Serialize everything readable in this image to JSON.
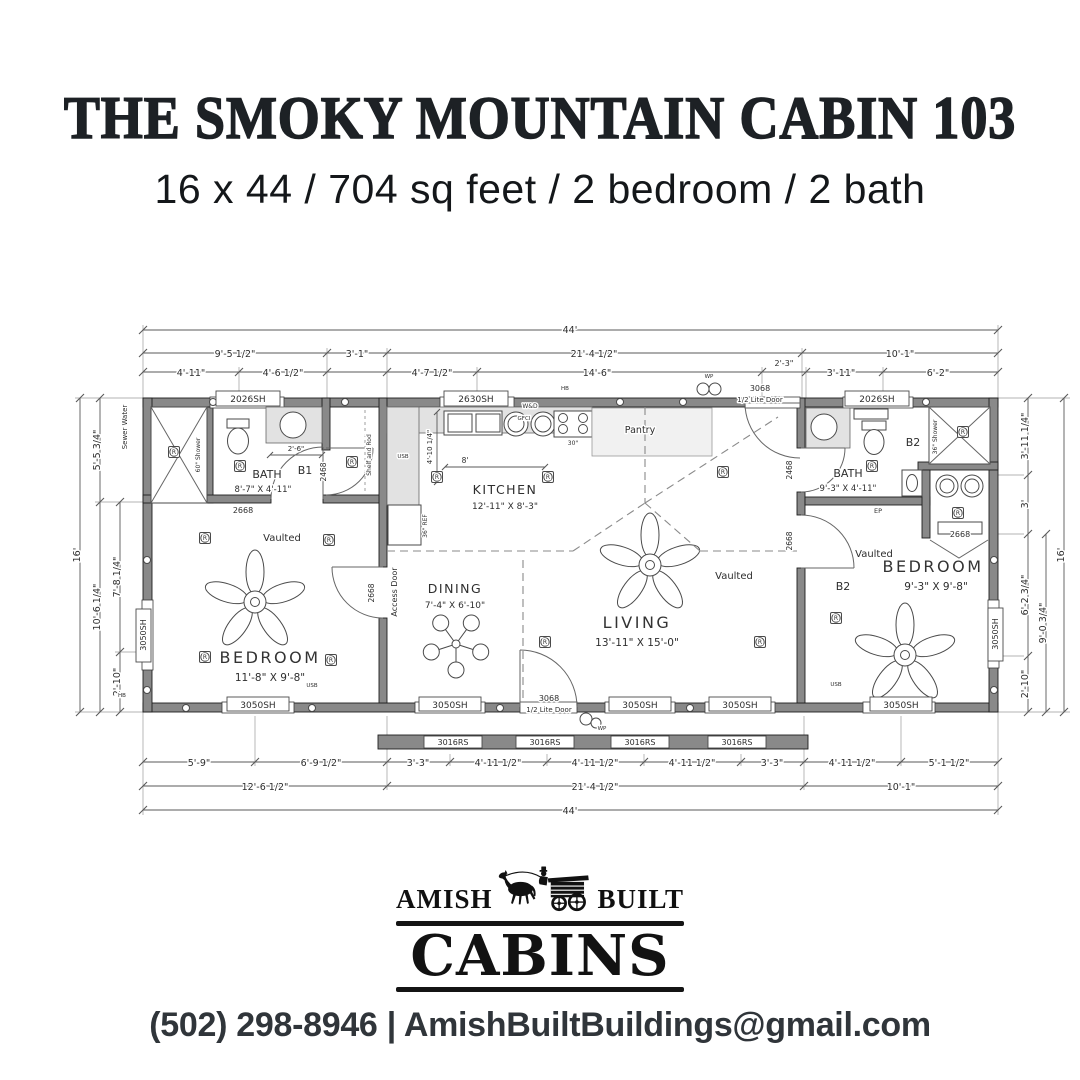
{
  "header": {
    "title": "THE SMOKY MOUNTAIN CABIN 103",
    "subtitle": "16 x 44 / 704 sq feet / 2 bedroom / 2 bath"
  },
  "plan": {
    "dims_top": {
      "row1": [
        "44'"
      ],
      "row2": [
        "9'-5 1/2\"",
        "3'-1\"",
        "21'-4 1/2\"",
        "10'-1\""
      ],
      "row3": [
        "4'-11\"",
        "4'-6 1/2\"",
        "4'-7 1/2\"",
        "14'-6\"",
        "2'-3\"",
        "3'-11\"",
        "6'-2\""
      ]
    },
    "dims_bottom": {
      "row1": [
        "5'-9\"",
        "6'-9 1/2\"",
        "3'-3\"",
        "4'-11 1/2\"",
        "4'-11 1/2\"",
        "4'-11 1/2\"",
        "3'-3\"",
        "4'-11 1/2\"",
        "5'-1 1/2\""
      ],
      "row2": [
        "12'-6 1/2\"",
        "21'-4 1/2\"",
        "10'-1\""
      ],
      "row3": [
        "44'"
      ]
    },
    "dims_left": [
      "16'",
      "5'-5 3/4\"",
      "10'-6 1/4\"",
      "7'-8 1/4\"",
      "2'-10\""
    ],
    "dims_right": [
      "3'-11 1/4\"",
      "3'",
      "6'-2 3/4\"",
      "2'-10\"",
      "9'-0 3/4\"",
      "16'"
    ],
    "rooms": {
      "bath1": {
        "name": "BATH",
        "dims": "8'-7\" X 4'-11\""
      },
      "bedroom1": {
        "name": "BEDROOM",
        "dims": "11'-8\" X 9'-8\""
      },
      "kitchen": {
        "name": "KITCHEN",
        "dims": "12'-11\" X 8'-3\""
      },
      "dining": {
        "name": "DINING",
        "dims": "7'-4\" X 6'-10\""
      },
      "living": {
        "name": "LIVING",
        "dims": "13'-11\" X 15'-0\""
      },
      "bath2": {
        "name": "BATH",
        "dims": "9'-3\" X 4'-11\""
      },
      "bedroom2": {
        "name": "BEDROOM",
        "dims": "9'-3\" X 9'-8\""
      }
    },
    "labels": {
      "vaulted": "Vaulted",
      "access_door": "Access Door",
      "shelf_rod": "Shelf and Rod",
      "b1": "B1",
      "b2": "B2",
      "shower_60": "60\" Shower",
      "shower_36": "36\" Shower",
      "fridge": "36\" REF",
      "range": "30\"",
      "wd": "W&D",
      "pantry": "Pantry",
      "recessed": "R",
      "dim_2_6": "2'-6\"",
      "dim_8": "8'",
      "dim_4_10": "4'-10 1/4\""
    },
    "utilities": {
      "sewer_water": "Sewer Water",
      "hb": "HB",
      "wp": "WP",
      "ep": "EP",
      "usb": "USB",
      "gfci": "GFCI"
    },
    "windows": {
      "sh2026": "2026SH",
      "sh2630": "2630SH",
      "sh3050": "3050SH",
      "rs3016": "3016RS"
    },
    "doors": {
      "d2468": "2468",
      "d2668": "2668",
      "d3068_num": "3068",
      "d3068_type": "1/2 Lite Door"
    }
  },
  "logo": {
    "amish": "AMISH",
    "built": "BUILT",
    "cabins": "CABINS"
  },
  "footer": {
    "phone": "(502) 298-8946",
    "divider": "|",
    "email": "AmishBuiltBuildings@gmail.com"
  }
}
